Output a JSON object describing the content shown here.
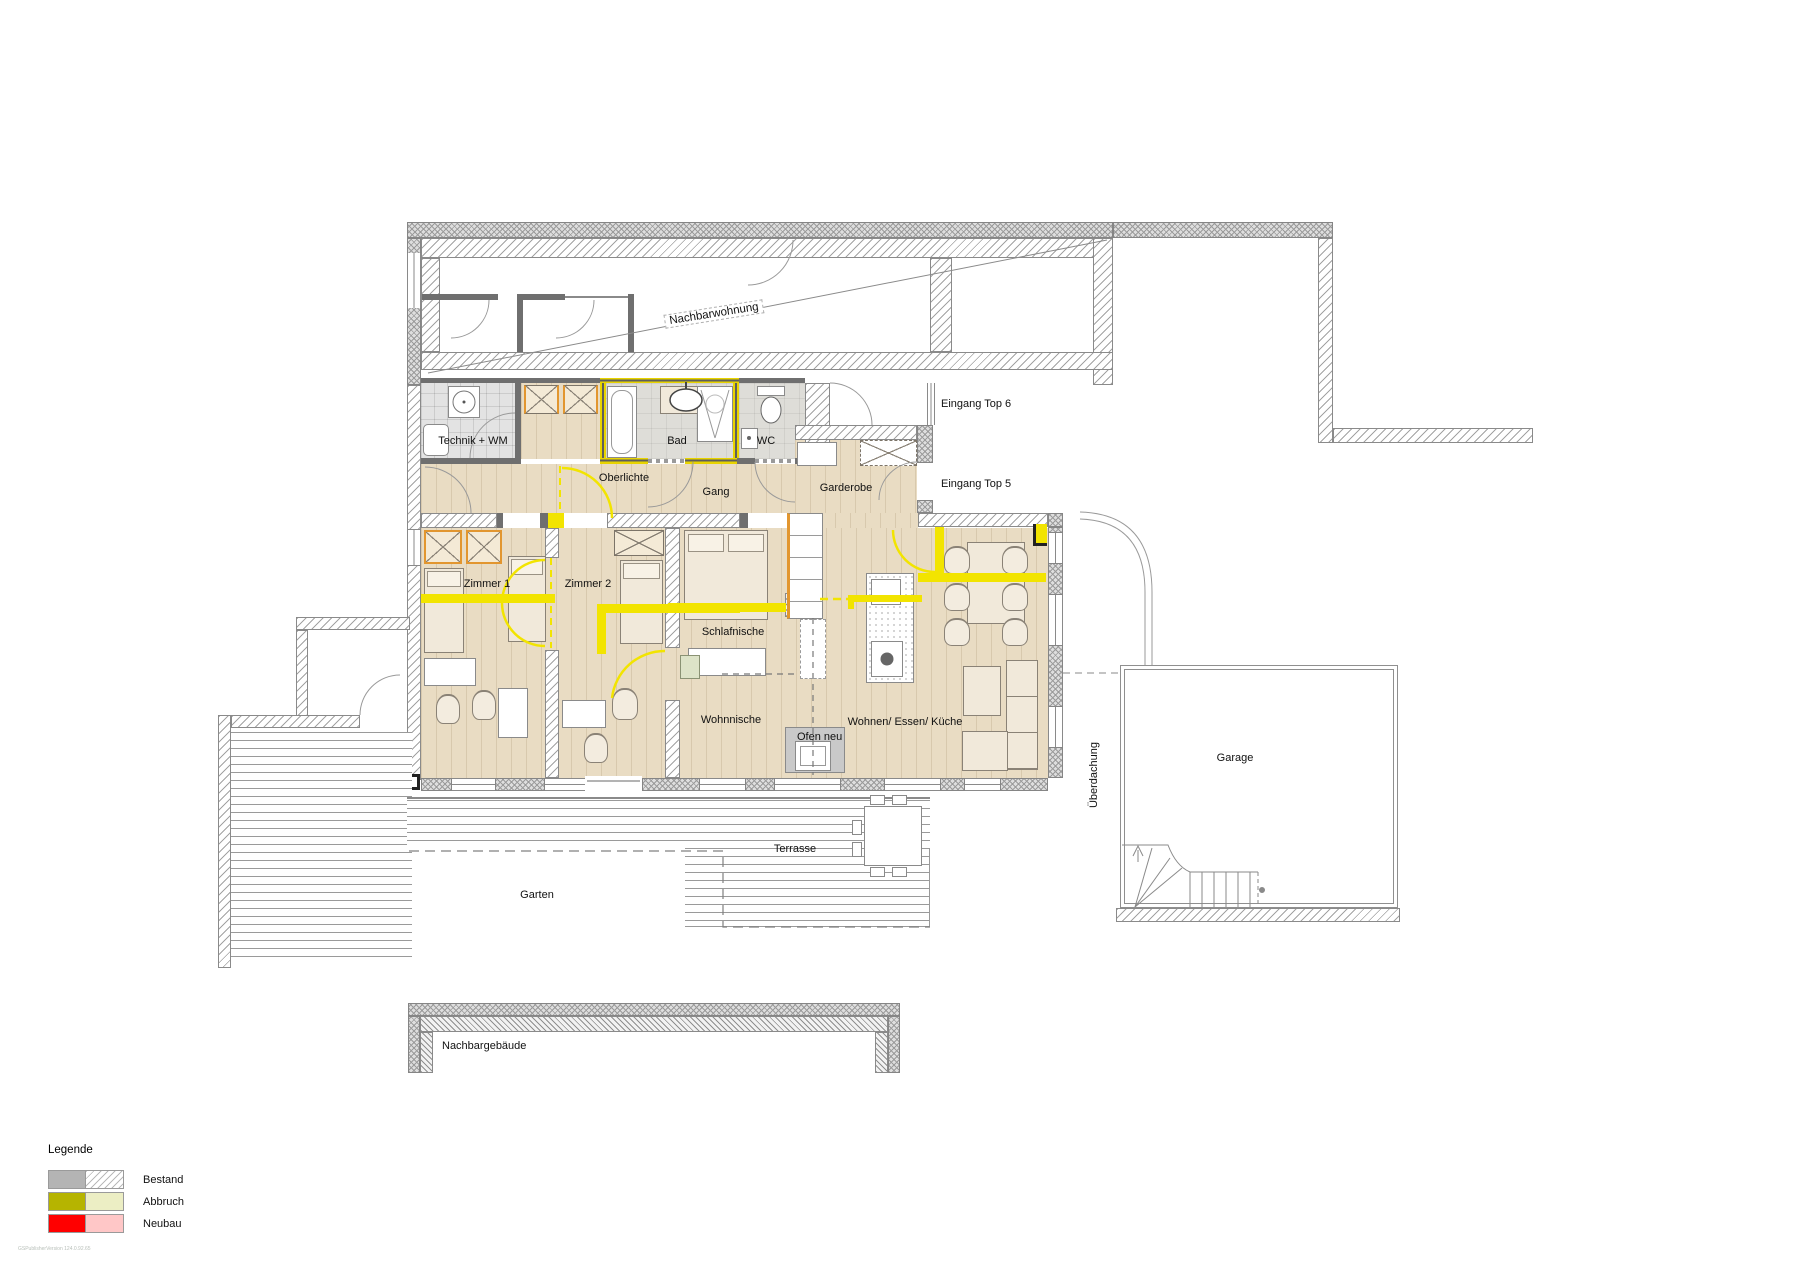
{
  "rooms": {
    "nachbarwohnung": "Nachbarwohnung",
    "technik": "Technik + WM",
    "bad": "Bad",
    "wc": "WC",
    "oberlichte": "Oberlichte",
    "gang": "Gang",
    "garderobe": "Garderobe",
    "eingang_top6": "Eingang Top 6",
    "eingang_top5": "Eingang Top 5",
    "zimmer1": "Zimmer 1",
    "zimmer2": "Zimmer 2",
    "schlafnische": "Schlafnische",
    "wohnnische": "Wohnnische",
    "ofen_neu": "Ofen neu",
    "wohnen_essen_kueche": "Wohnen/ Essen/ Küche",
    "ueberdachung": "Überdachung",
    "garage": "Garage",
    "terrasse": "Terrasse",
    "garten": "Garten",
    "nachbargebaeude": "Nachbargebäude"
  },
  "legend": {
    "title": "Legende",
    "items": [
      {
        "label": "Bestand",
        "solid": "#b4b4b4",
        "secondary": "white-diagonal-hatch"
      },
      {
        "label": "Abbruch",
        "solid": "#b6b400",
        "secondary": "#eceec4"
      },
      {
        "label": "Neubau",
        "solid": "#ff0000",
        "secondary": "#ffc7c7"
      }
    ]
  },
  "colors": {
    "abbruch_yellow_lines": "#f2e400",
    "demolition_wall": "#e8d400",
    "new_wood_orange": "#e2962f",
    "wood_floor": "#e9dcc3",
    "wall_hatch_gray": "#9b9b9b"
  },
  "watermark": "GSPublisherVersion 124.0.92.65"
}
